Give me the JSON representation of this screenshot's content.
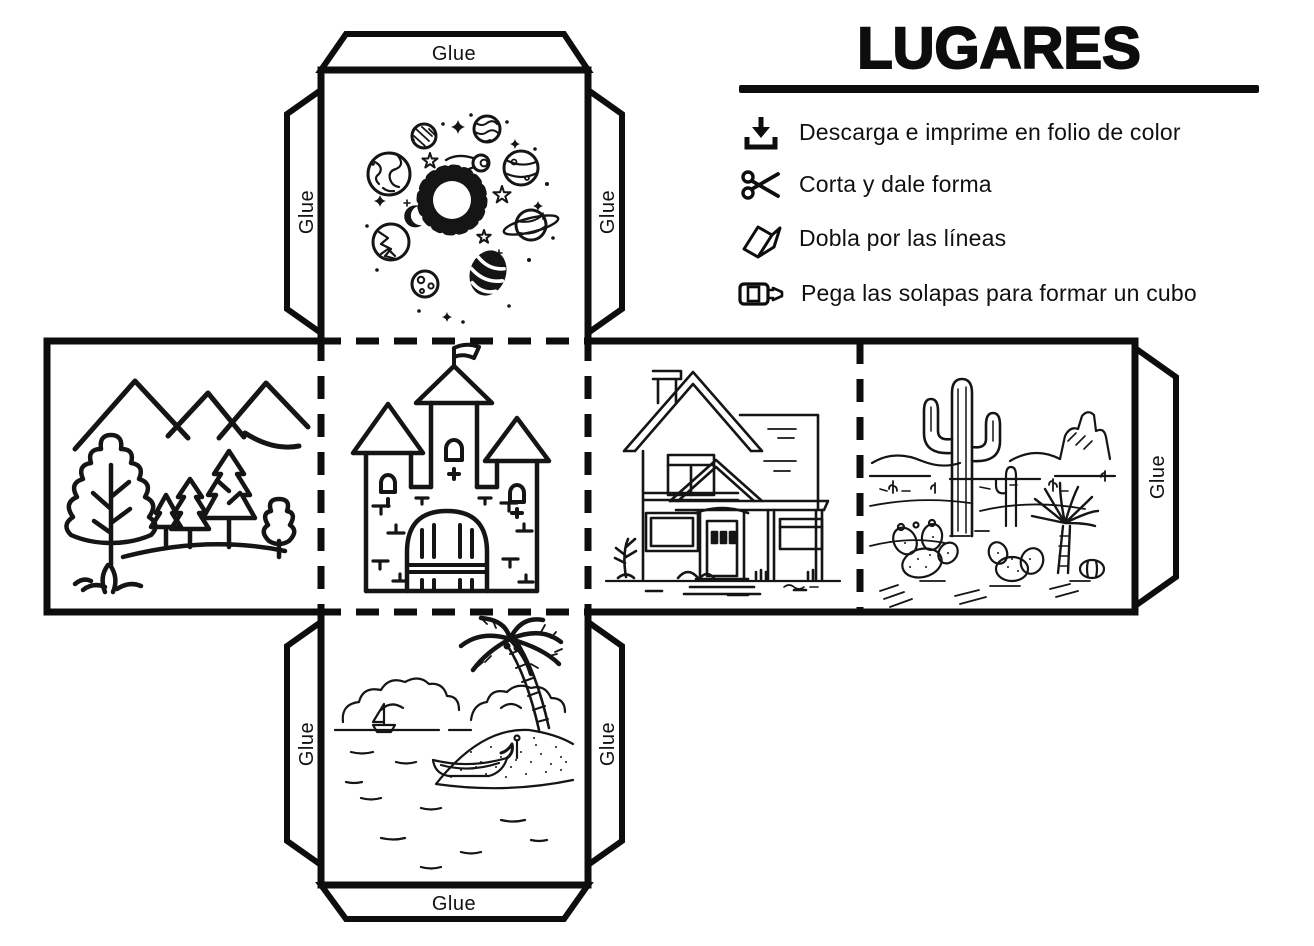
{
  "title": "LUGARES",
  "instructions": [
    {
      "icon": "download-icon",
      "text": "Descarga e imprime en folio de color"
    },
    {
      "icon": "scissors-icon",
      "text": "Corta y dale forma"
    },
    {
      "icon": "fold-icon",
      "text": "Dobla por las líneas"
    },
    {
      "icon": "glue-stick-icon",
      "text": "Pega las solapas para formar un cubo"
    }
  ],
  "net": {
    "glue_label": "Glue",
    "faces": [
      {
        "id": "space",
        "depicts": "sun, planets and stars"
      },
      {
        "id": "mountains",
        "depicts": "mountains and forest trees"
      },
      {
        "id": "castle",
        "depicts": "castle with three towers and flag"
      },
      {
        "id": "house",
        "depicts": "two-story house with porch"
      },
      {
        "id": "desert",
        "depicts": "saguaro cactus desert scene"
      },
      {
        "id": "beach",
        "depicts": "beach with palm tree and boats"
      }
    ],
    "flap_count": 7
  },
  "colors": {
    "ink": "#0d0d0d",
    "background": "#ffffff"
  }
}
